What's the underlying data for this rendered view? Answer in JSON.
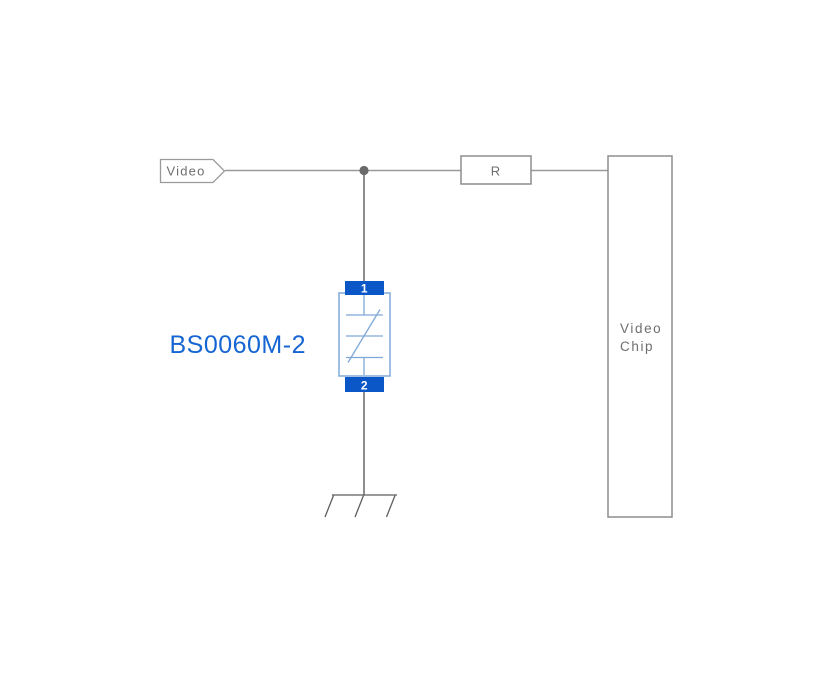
{
  "schematic": {
    "net_flag": {
      "label": "Video"
    },
    "resistor": {
      "label": "R"
    },
    "video_chip": {
      "line1": "Video",
      "line2": "Chip"
    },
    "tvs": {
      "part_number": "BS0060M-2",
      "pin_top": "1",
      "pin_bottom": "2"
    },
    "colors": {
      "accent_blue": "#0b57c8",
      "accent_blue_light": "#7fa8d9",
      "part_label_blue": "#1565d2",
      "wire_gray": "#9a9a9a",
      "wire_dark": "#5e5e5e",
      "box_border_gray": "#8d8d8d",
      "text_gray": "#6e6e6e",
      "junction_gray": "#6a6a6a"
    }
  }
}
